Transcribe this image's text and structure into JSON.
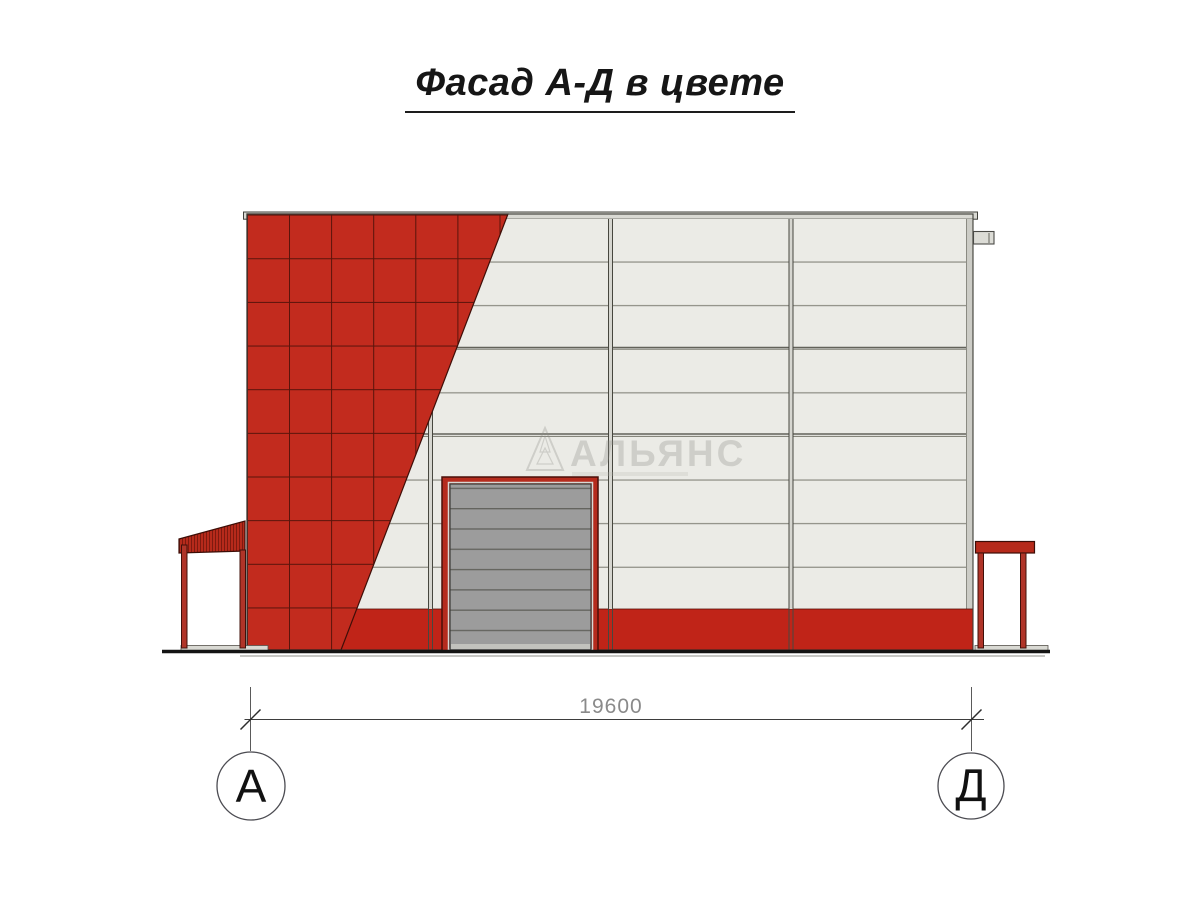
{
  "title": {
    "text": "Фасад А-Д в цвете"
  },
  "watermark": {
    "text": "АЛЬЯНС",
    "logo": "triangle-tree-icon"
  },
  "dimension": {
    "value": "19600"
  },
  "axis_markers": {
    "left_label": "А",
    "right_label": "Д"
  },
  "colors": {
    "facade_red": "#c22b1e",
    "plinth_red": "#c02418",
    "frame_red": "#b52b1d",
    "canopy_red": "#b62a1b",
    "post_red": "#b03428",
    "wall_white": "#ebebe6",
    "door_gray": "#9c9c9c",
    "coping_gray": "#d9d9d3",
    "ground_black": "#141414",
    "dim_gray": "#8a8a8a"
  }
}
